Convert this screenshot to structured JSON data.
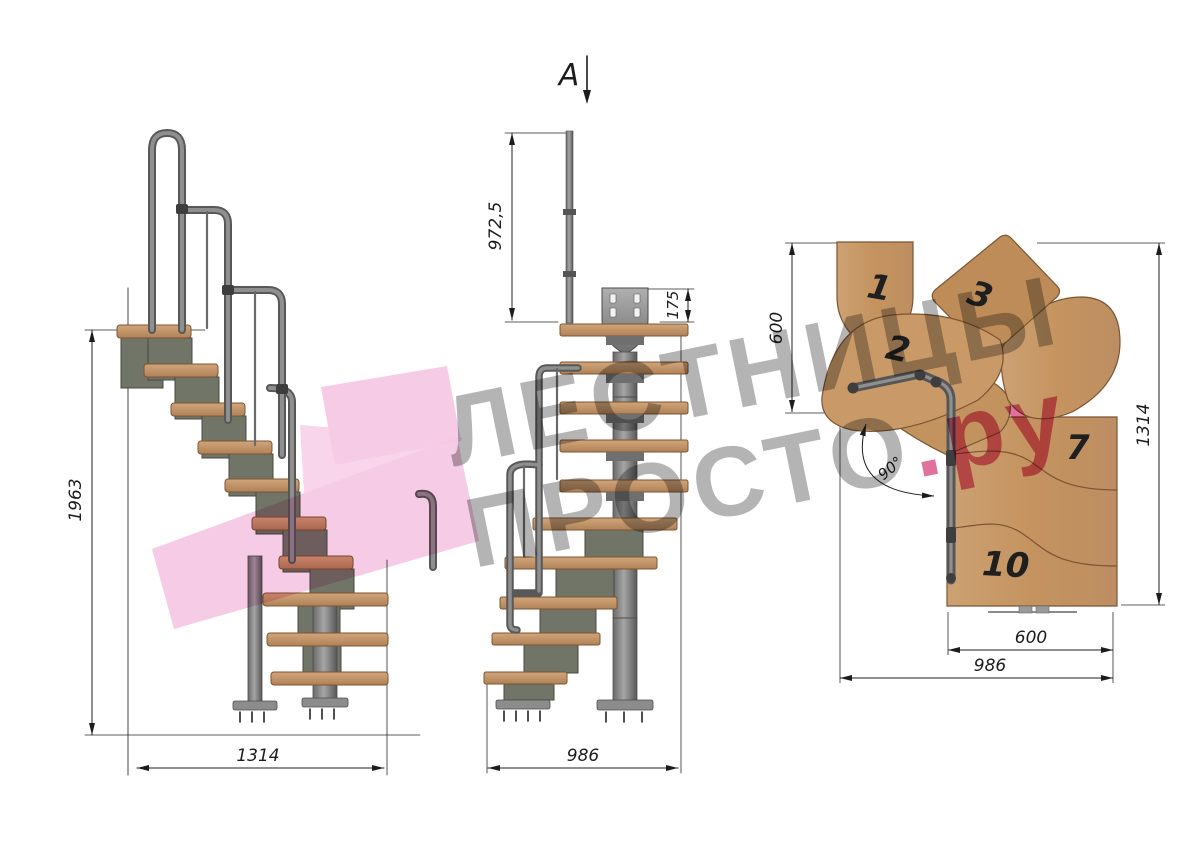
{
  "watermark": {
    "line1": "ЛЕСТНИЦЫ",
    "line2": "ПРОСТО",
    "suffix": ".ру"
  },
  "views": {
    "side": {
      "dim_height": "1963",
      "dim_length": "1314"
    },
    "front": {
      "section_letter": "A",
      "dim_rail_height": "972,5",
      "dim_plate": "175",
      "dim_width": "986"
    },
    "plan": {
      "dim_top": "600",
      "dim_right": "1314",
      "dim_tread": "600",
      "dim_total": "986",
      "dim_angle": "90°",
      "tread_numbers": [
        "1",
        "2",
        "3",
        "7",
        "10"
      ]
    }
  },
  "colors": {
    "wood": "#c79b6f",
    "wood_dark": "#b08156",
    "metal": "#7a7a7a",
    "dimension_line": "#2a2a2a",
    "watermark_gray": "#b4b4b4",
    "watermark_pink": "#e0719c",
    "logo_pink": "#f3bade"
  }
}
